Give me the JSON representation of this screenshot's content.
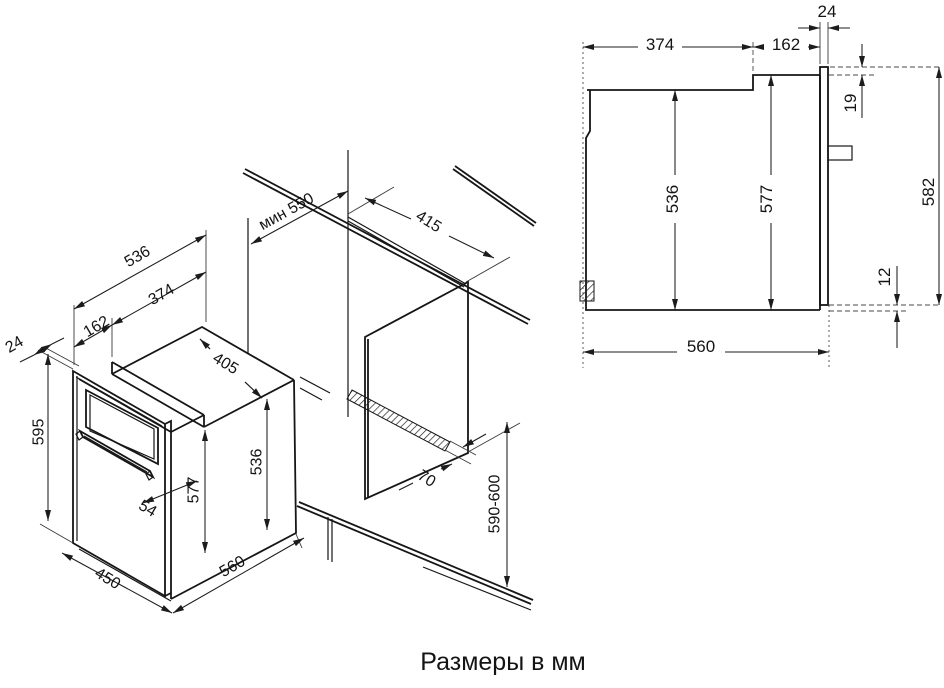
{
  "caption": "Размеры в мм",
  "iso_view": {
    "dims": {
      "depth_total": "536",
      "depth_rear": "374",
      "depth_front": "162",
      "door_thickness": "24",
      "front_height": "595",
      "width": "450",
      "body_depth": "560",
      "door_gap": "54",
      "body_height": "577",
      "rear_height": "536",
      "top_width": "405",
      "worktop_min": "мин 550",
      "niche_top_depth": "415",
      "vent_gap": "70",
      "niche_height": "590-600"
    }
  },
  "side_view": {
    "dims": {
      "depth_rear": "374",
      "depth_front": "162",
      "door_thickness": "24",
      "door_overhang_top": "19",
      "rear_height": "536",
      "body_height": "577",
      "door_height": "582",
      "door_overhang_bottom": "12",
      "body_depth": "560"
    }
  }
}
